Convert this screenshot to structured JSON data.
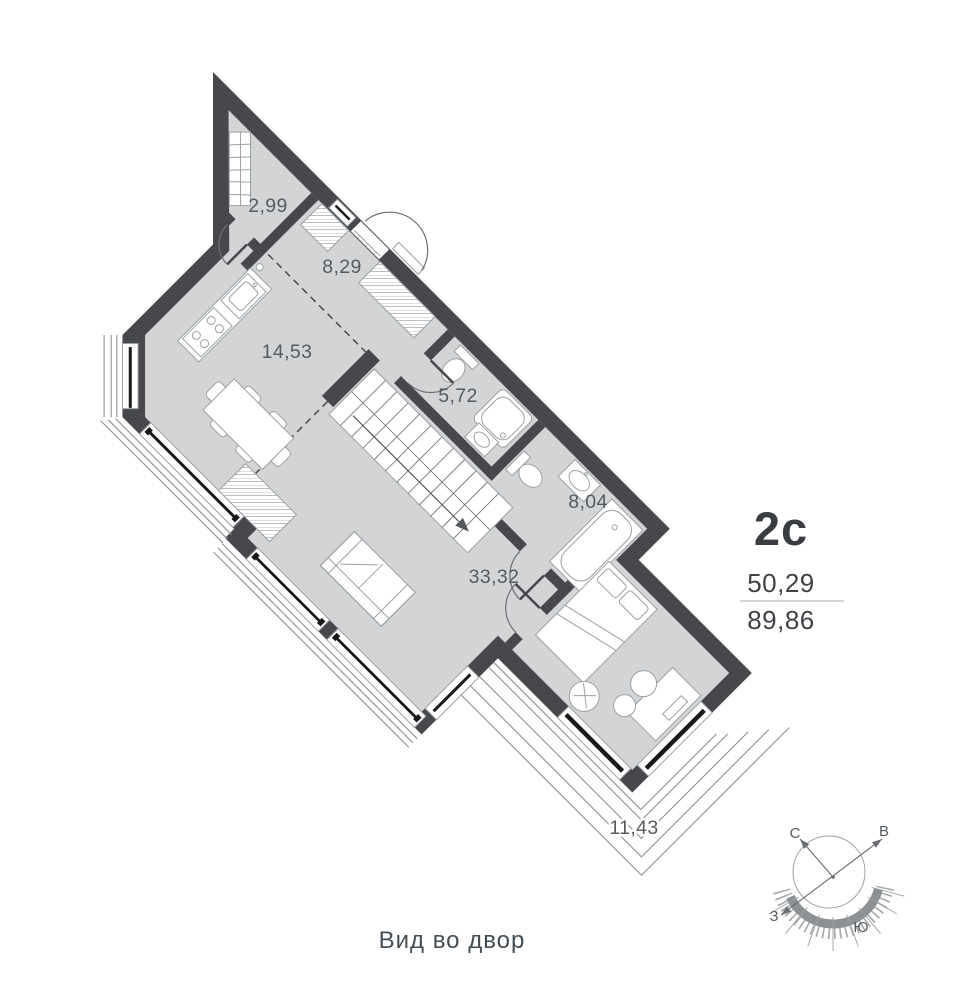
{
  "unit": {
    "title": "2с",
    "area_living": "50,29",
    "area_total": "89,86"
  },
  "caption": "Вид во двор",
  "rooms": [
    {
      "id": "wardrobe",
      "area": "2,99"
    },
    {
      "id": "hallway",
      "area": "8,29"
    },
    {
      "id": "kitchen",
      "area": "14,53"
    },
    {
      "id": "bathroom",
      "area": "5,72"
    },
    {
      "id": "bathroom-2",
      "area": "8,04"
    },
    {
      "id": "living-room",
      "area": "33,32"
    },
    {
      "id": "terrace",
      "area": "11,43"
    }
  ],
  "compass": {
    "north": "С",
    "east": "В",
    "west": "З",
    "south": "Ю"
  },
  "colors": {
    "wall": "#47484c",
    "floor": "#d3d4d5",
    "fixture_stroke": "#9aa0a4",
    "label": "#565b60",
    "title": "#393d41",
    "glass": "#17191b",
    "railing": "#8c9093"
  }
}
